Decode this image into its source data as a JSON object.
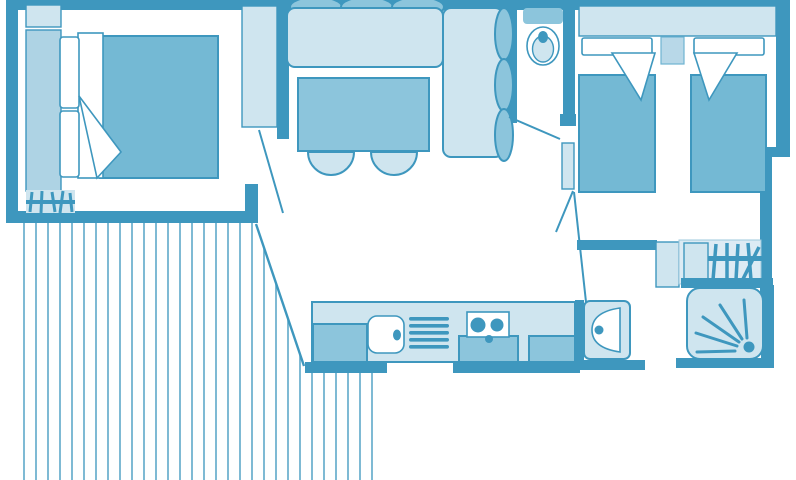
{
  "plan": {
    "type": "floor-plan",
    "description": "top-down mobile-home / holiday-cottage floor plan drawn in blue line art",
    "rooms": [
      "master-bedroom",
      "living-room",
      "wc",
      "twin-bedroom",
      "kitchen",
      "bathroom",
      "hallway",
      "deck-terrace"
    ],
    "fixtures": [
      "double-bed",
      "pillows",
      "folded-sheet",
      "wardrobe",
      "corner-shelf",
      "luggage-rack",
      "l-shaped-sofa",
      "seat-cushions",
      "dining-table",
      "two-stools",
      "toilet",
      "single-bed-left",
      "single-bed-right",
      "nightstand",
      "headboard-shelf",
      "kitchen-counter",
      "sink",
      "dish-drainer",
      "two-burner-hob",
      "base-cabinets",
      "washbasin",
      "shower-tray",
      "drying-rack",
      "door-swings",
      "deck-boards"
    ],
    "deck": {
      "board_spacing_px": 12,
      "board_count": 30
    }
  },
  "colors": {
    "wall": "#3e97be",
    "mid": "#8cc5dc",
    "blanket": "#74b9d4",
    "light": "#cfe5ef",
    "lighter": "#dcebf4",
    "wardrobe": "#aed3e4",
    "nightstand": "#b8d8e8",
    "stripe": "#5fa9c9",
    "bg": "#ffffff"
  }
}
